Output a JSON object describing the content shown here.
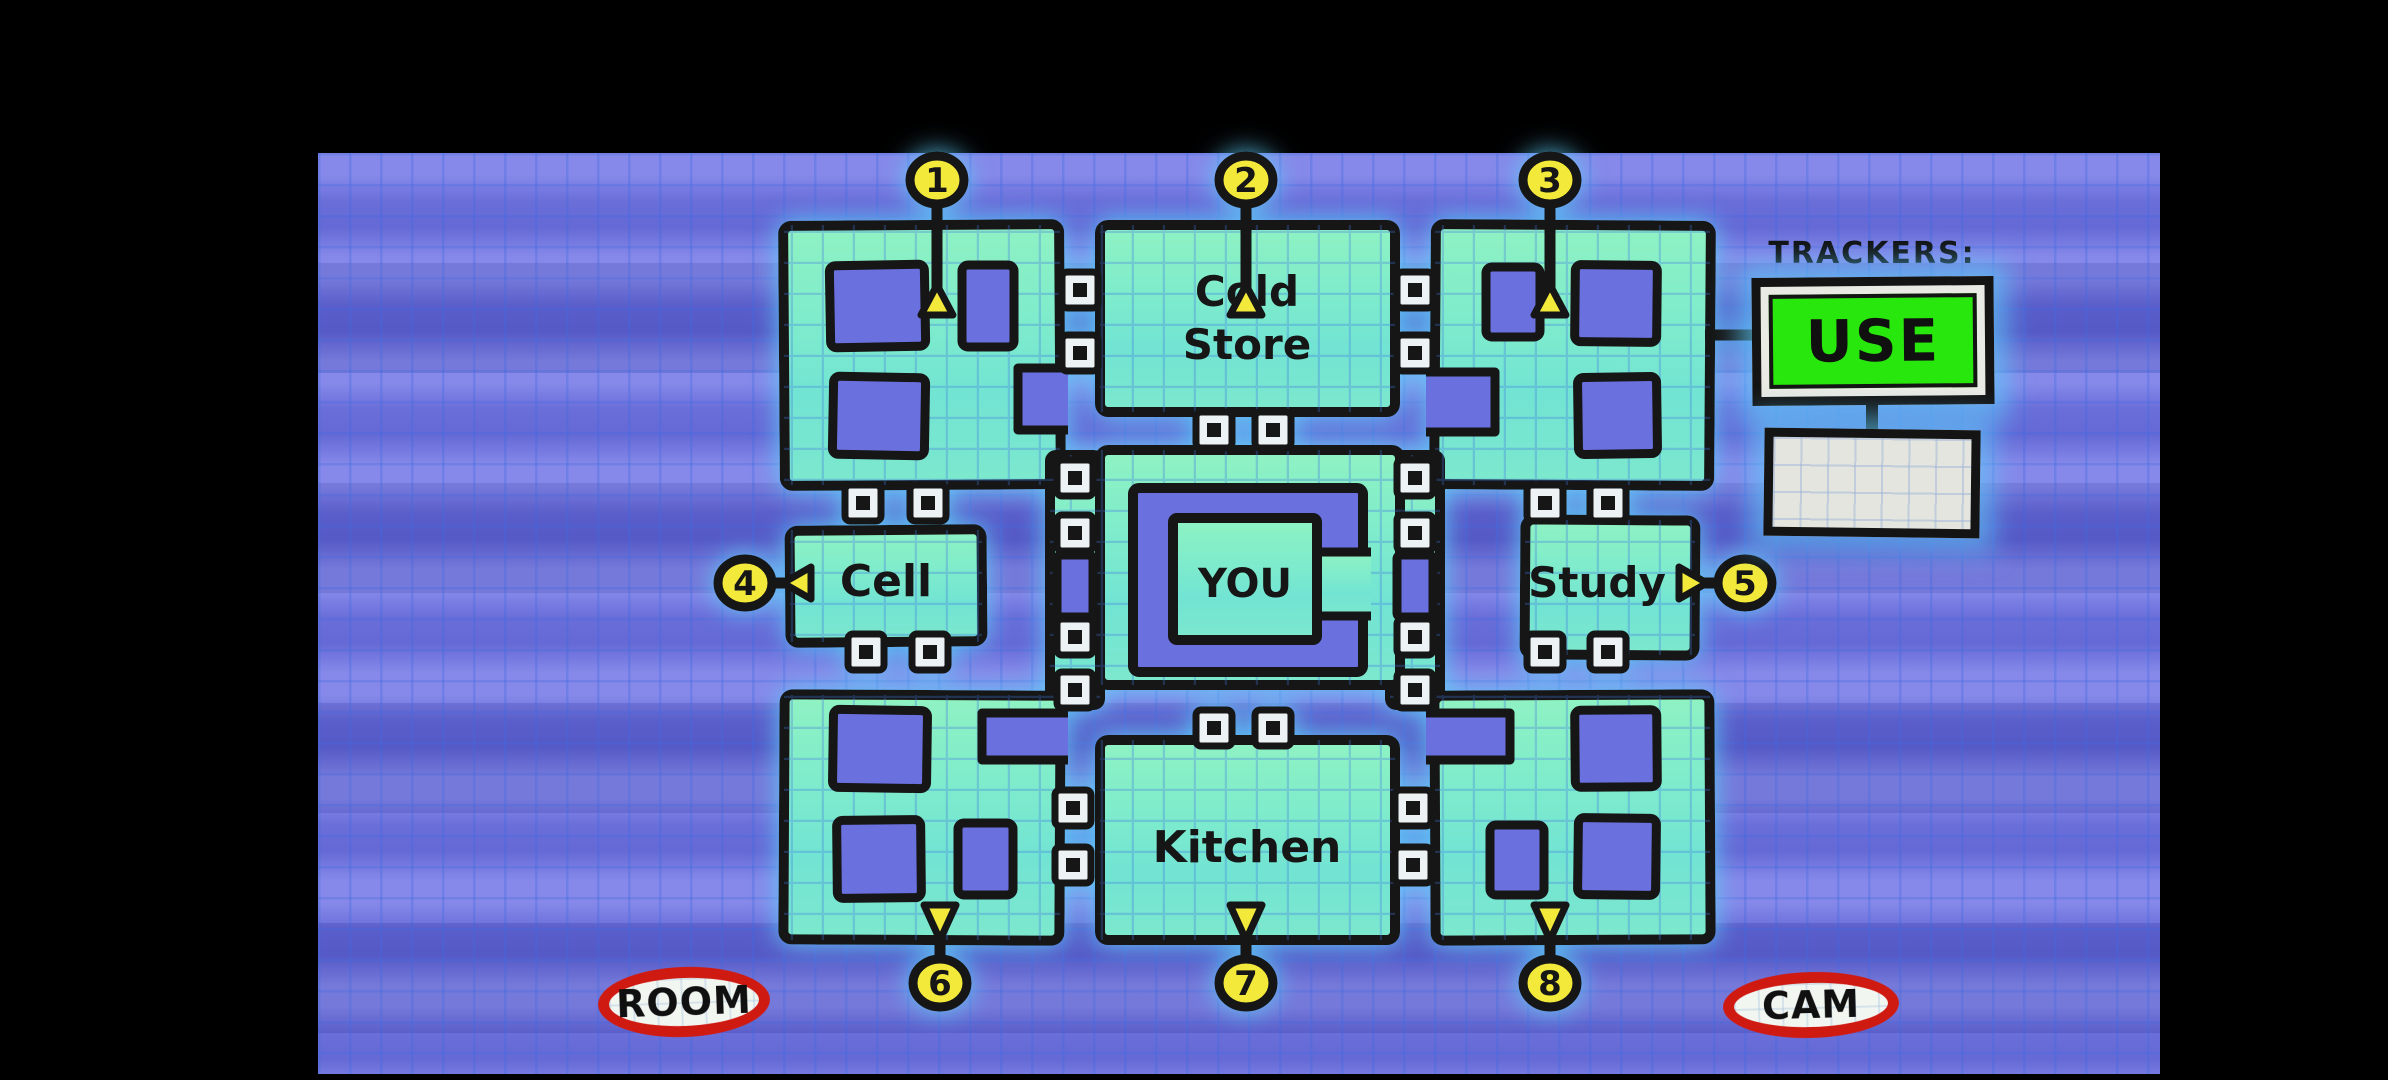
{
  "map": {
    "rooms": {
      "cold_store_line1": "Cold",
      "cold_store_line2": "Store",
      "cell": "Cell",
      "you": "YOU",
      "study": "Study",
      "kitchen": "Kitchen"
    },
    "markers": [
      {
        "number": "1",
        "direction": "up"
      },
      {
        "number": "2",
        "direction": "up"
      },
      {
        "number": "3",
        "direction": "up"
      },
      {
        "number": "4",
        "direction": "left"
      },
      {
        "number": "5",
        "direction": "right"
      },
      {
        "number": "6",
        "direction": "down"
      },
      {
        "number": "7",
        "direction": "down"
      },
      {
        "number": "8",
        "direction": "down"
      }
    ]
  },
  "trackers": {
    "title": "TRACKERS:",
    "use_button": "USE"
  },
  "footer": {
    "room_button": "ROOM",
    "cam_button": "CAM"
  },
  "colors": {
    "room_fill": "#7fe9cb",
    "wall": "#141414",
    "background_blue": "#666bd9",
    "marker_yellow": "#f2e93a",
    "use_green": "#28e70c",
    "button_red": "#cf1a12",
    "glow_cyan": "#5ecdf8"
  }
}
